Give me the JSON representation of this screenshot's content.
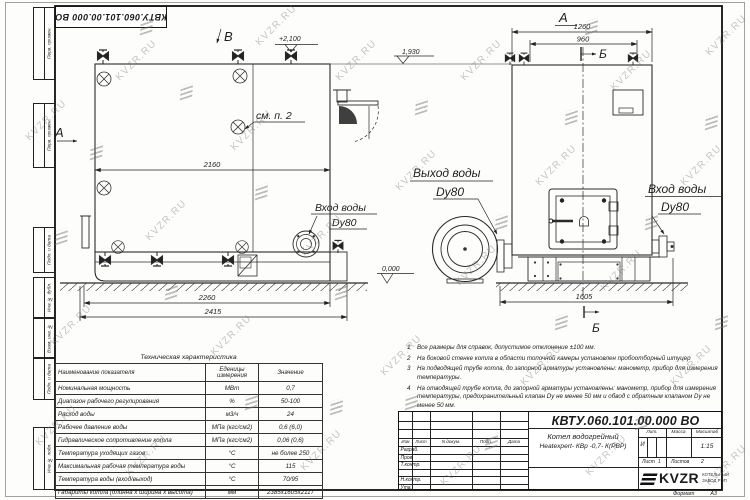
{
  "doc": {
    "number": "КВТУ.060.101.00.000  ВО"
  },
  "margin": [
    "Перв. примен.",
    "Перв. примен.",
    "Подп. и дата",
    "Инв. № дубл.",
    "Взам. инв. №",
    "Подп. и дата",
    "Инв. № подл."
  ],
  "views": {
    "mark_a": "А",
    "mark_b": "В",
    "section_b": "Б",
    "front_title": "А",
    "see_note": "см. п. 2"
  },
  "levels": {
    "top": "+2,100",
    "mid": "1,930",
    "zero": "0,000"
  },
  "dims": {
    "body_len": "2160",
    "base_len": "2260",
    "overall_len": "2415",
    "front_top": "1260",
    "front_inner": "960",
    "front_width": "1605"
  },
  "pipes": {
    "inlet": "Вход воды",
    "outlet": "Выход воды",
    "dy": "Dy80"
  },
  "tech_table": {
    "title": "Техническая характеристика",
    "headers": [
      "Наименование показателя",
      "Еденицы\nизмерения",
      "Значение"
    ],
    "rows": [
      [
        "Номинальная мощность",
        "МВт",
        "0,7"
      ],
      [
        "Диапазон рабочего регулирования",
        "%",
        "50-100"
      ],
      [
        "Расход воды",
        "м3/ч",
        "24"
      ],
      [
        "Рабочее давление воды",
        "МПа (кгс/см2)",
        "0,6 (6,0)"
      ],
      [
        "Гидравлическое сопротивление котла",
        "МПа (кгс/см2)",
        "0,06 (0,6)"
      ],
      [
        "Температура уходящих газов",
        "°С",
        "не более 250"
      ],
      [
        "Максимальная рабочая температура воды",
        "°С",
        "115"
      ],
      [
        "Температура воды (вход/выход)",
        "°С",
        "70/95"
      ],
      [
        "Габариты котла (длинна х ширина х высота)",
        "мм",
        "2385х1605х2117"
      ]
    ]
  },
  "notes": [
    {
      "num": "1",
      "text": "Все размеры для справок, допустимое отклонение ±100 мм."
    },
    {
      "num": "2",
      "text": "На боковой стенке котла в области топочной камеры установлен пробоотборный штуцер"
    },
    {
      "num": "3",
      "text": "На подводящей трубе котла, до запорной арматуры установлены: манометр, прибор для измерения температуры."
    },
    {
      "num": "4",
      "text": "На отводящей трубе котла, до запорной арматуры установлены: манометр, прибор для измерения температуры, предохранительный клапан Dу не менее 50 мм и обвод с обратным клапаном Dу не менее 50 мм."
    }
  ],
  "title_block": {
    "name_line1": "Котел водогрейный",
    "name_line2": "Heatexpert- КВр -0,7- К(РВР)",
    "col_izm": "Изм",
    "col_list": "Лист",
    "col_doc": "N докум.",
    "col_podp": "Подп.",
    "col_data": "Дата",
    "rows": [
      "Разраб.",
      "Пров.",
      "Т.контр.",
      "Н.контр.",
      "Утв."
    ],
    "lit": "Лит.",
    "massa": "Масса",
    "scale": "Масштаб",
    "lit_value": "И",
    "scale_value": "1:15",
    "sheet": "Лист",
    "sheet_value": "1",
    "sheets": "Листов",
    "sheets_value": "2",
    "logo": "KVZR",
    "company_line1": "КОТЕЛЬНЫЙ",
    "company_line2": "ЗАВОД РЭП",
    "format_label": "Формат",
    "format_value": "А3"
  },
  "watermarks": {
    "text": "KVZR.RU",
    "items": [
      [
        20,
        115,
        0
      ],
      [
        110,
        55,
        0
      ],
      [
        45,
        320,
        0
      ],
      [
        140,
        215,
        0
      ],
      [
        225,
        125,
        0
      ],
      [
        205,
        330,
        0
      ],
      [
        295,
        230,
        0
      ],
      [
        330,
        55,
        0
      ],
      [
        295,
        445,
        0
      ],
      [
        390,
        165,
        0
      ],
      [
        375,
        350,
        0
      ],
      [
        455,
        55,
        0
      ],
      [
        450,
        260,
        0
      ],
      [
        435,
        460,
        0
      ],
      [
        530,
        160,
        0
      ],
      [
        515,
        360,
        0
      ],
      [
        605,
        65,
        0
      ],
      [
        595,
        265,
        0
      ],
      [
        580,
        450,
        0
      ],
      [
        675,
        160,
        0
      ],
      [
        665,
        360,
        0
      ],
      [
        700,
        30,
        0
      ],
      [
        120,
        450,
        0
      ],
      [
        700,
        460,
        0
      ],
      [
        250,
        20,
        0
      ],
      [
        30,
        420,
        0
      ],
      [
        90,
        145,
        1
      ],
      [
        180,
        85,
        1
      ],
      [
        165,
        285,
        1
      ],
      [
        255,
        185,
        1
      ],
      [
        245,
        395,
        1
      ],
      [
        335,
        285,
        1
      ],
      [
        415,
        100,
        1
      ],
      [
        405,
        395,
        1
      ],
      [
        495,
        215,
        1
      ],
      [
        485,
        435,
        1
      ],
      [
        565,
        110,
        1
      ],
      [
        555,
        315,
        1
      ],
      [
        645,
        215,
        1
      ],
      [
        635,
        415,
        1
      ],
      [
        705,
        115,
        1
      ],
      [
        55,
        230,
        1
      ],
      [
        715,
        315,
        1
      ],
      [
        330,
        400,
        1
      ],
      [
        585,
        20,
        1
      ],
      [
        140,
        20,
        1
      ]
    ]
  }
}
